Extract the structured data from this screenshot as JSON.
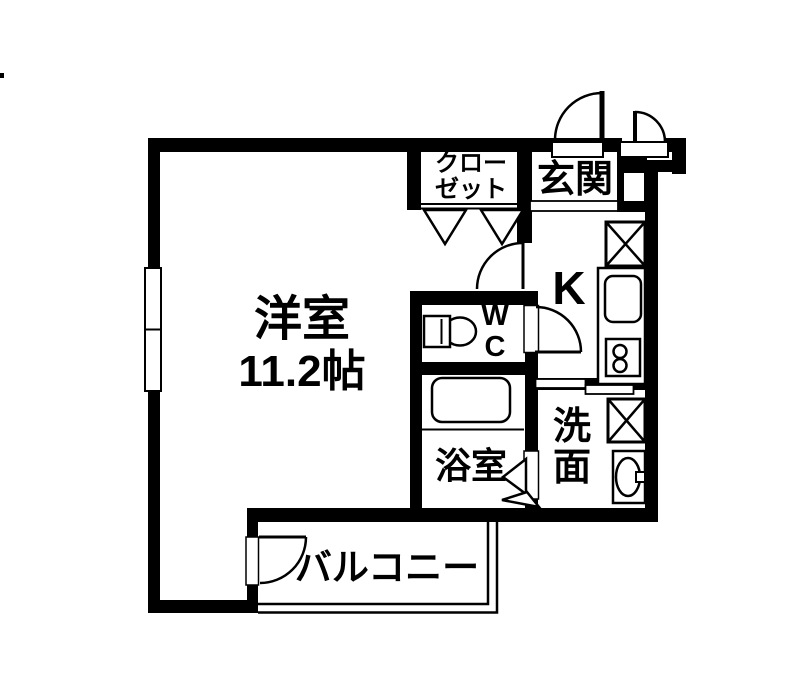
{
  "canvas": {
    "width_px": 795,
    "height_px": 678,
    "background_color": "#ffffff",
    "line_color": "#000000"
  },
  "rooms": {
    "living": {
      "name": "洋室",
      "size": "11.2帖"
    },
    "closet": {
      "name": "クロー\nゼット"
    },
    "entrance": {
      "name": "玄関"
    },
    "kitchen": {
      "name": "K"
    },
    "toilet": {
      "name": "W\nC"
    },
    "bathroom": {
      "name": "浴室"
    },
    "washroom": {
      "name": "洗\n面"
    },
    "balcony": {
      "name": "バルコニー"
    }
  },
  "fixtures": [
    "entrance-door",
    "storage-door",
    "living-room-door",
    "toilet-door",
    "bathroom-folding-door",
    "balcony-door",
    "closet-folding-doors",
    "window",
    "refrigerator-space",
    "kitchen-sink",
    "gas-stove",
    "toilet-bowl",
    "bathtub",
    "washing-machine-space",
    "wash-basin",
    "balcony-railing",
    "entrance-step"
  ]
}
